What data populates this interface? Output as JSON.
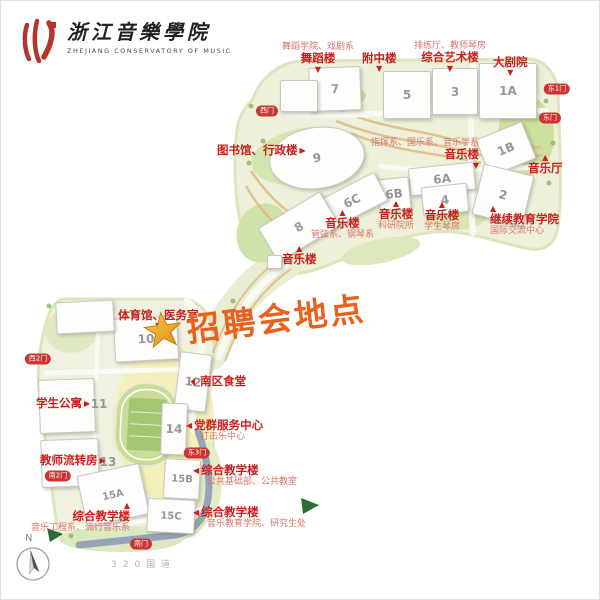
{
  "logo": {
    "title": "浙江音樂學院",
    "subtitle": "ZHEJIANG CONSERVATORY OF MUSIC"
  },
  "announcement": {
    "text": "招聘会地点",
    "color": "#e8611d",
    "star_color": "#f2a71f"
  },
  "compass": {
    "label": "N"
  },
  "highway": {
    "label": "320国道"
  },
  "colors": {
    "label_red": "#c8201d",
    "sub_red": "#d6756b",
    "gate_red": "#cc3433",
    "number_gray": "#97979a",
    "land_green": "#eef0da",
    "road_blue": "#97a3b8"
  },
  "map": {
    "buildings": [
      {
        "number": "7",
        "x": 308,
        "y": 66,
        "w": 50,
        "h": 42,
        "rot": -2
      },
      {
        "number": "5",
        "x": 382,
        "y": 70,
        "w": 46,
        "h": 46,
        "rot": 0
      },
      {
        "number": "3",
        "x": 431,
        "y": 67,
        "w": 44,
        "h": 45,
        "rot": 0
      },
      {
        "number": "1A",
        "x": 478,
        "y": 62,
        "w": 56,
        "h": 54,
        "rot": 0
      },
      {
        "number": "1B",
        "x": 480,
        "y": 128,
        "w": 48,
        "h": 38,
        "rot": -22
      },
      {
        "number": "2",
        "x": 476,
        "y": 168,
        "w": 50,
        "h": 50,
        "rot": 14
      },
      {
        "number": "9",
        "x": 268,
        "y": 126,
        "w": 94,
        "h": 60,
        "rot": -8,
        "shape": "ellipse"
      },
      {
        "number": "6A",
        "x": 408,
        "y": 164,
        "w": 64,
        "h": 26,
        "rot": -6
      },
      {
        "number": "6B",
        "x": 377,
        "y": 177,
        "w": 30,
        "h": 30,
        "rot": -6
      },
      {
        "number": "6C",
        "x": 318,
        "y": 184,
        "w": 64,
        "h": 30,
        "rot": -27
      },
      {
        "number": "4",
        "x": 421,
        "y": 184,
        "w": 44,
        "h": 27,
        "rot": -6
      },
      {
        "number": "8",
        "x": 262,
        "y": 206,
        "w": 70,
        "h": 38,
        "rot": -31
      },
      {
        "number": "",
        "x": 279,
        "y": 79,
        "w": 36,
        "h": 30,
        "rot": 0
      },
      {
        "number": "",
        "x": 266,
        "y": 254,
        "w": 13,
        "h": 12,
        "rot": 0
      },
      {
        "number": "10",
        "x": 113,
        "y": 316,
        "w": 62,
        "h": 42,
        "rot": -3
      },
      {
        "number": "",
        "x": 55,
        "y": 300,
        "w": 56,
        "h": 30,
        "rot": -3
      },
      {
        "number": "12",
        "x": 176,
        "y": 352,
        "w": 30,
        "h": 56,
        "rot": 7
      },
      {
        "number": "11",
        "x": 38,
        "y": 378,
        "w": 54,
        "h": 52,
        "rot": -2,
        "nx": 98,
        "ny": 403
      },
      {
        "number": "14",
        "x": 160,
        "y": 402,
        "w": 24,
        "h": 50,
        "rot": 2
      },
      {
        "number": "13",
        "x": 40,
        "y": 438,
        "w": 56,
        "h": 46,
        "rot": -2,
        "nx": 107,
        "ny": 461
      },
      {
        "number": "15B",
        "x": 163,
        "y": 458,
        "w": 34,
        "h": 38,
        "rot": 3
      },
      {
        "number": "15A",
        "x": 80,
        "y": 468,
        "w": 62,
        "h": 50,
        "rot": -12
      },
      {
        "number": "15C",
        "x": 146,
        "y": 498,
        "w": 46,
        "h": 32,
        "rot": 3
      }
    ],
    "labels": [
      {
        "main": "舞蹈楼",
        "sub": "舞蹈学院、戏剧系",
        "subpos": "above",
        "tri": "down",
        "tripos": "below",
        "x": 281,
        "y": 41,
        "align": "center"
      },
      {
        "main": "附中楼",
        "tri": "down",
        "tripos": "below",
        "x": 361,
        "y": 51,
        "align": "center"
      },
      {
        "main": "综合艺术楼",
        "sub": "排练厅、教师琴房",
        "subpos": "above",
        "tri": "down",
        "tripos": "below",
        "x": 413,
        "y": 40,
        "align": "center"
      },
      {
        "main": "大剧院",
        "tri": "down",
        "tripos": "below",
        "x": 492,
        "y": 55,
        "align": "center"
      },
      {
        "main": "图书馆、行政楼",
        "tri": "right",
        "tripos": "right",
        "x": 216,
        "y": 143,
        "align": "start"
      },
      {
        "main": "音乐楼",
        "sub": "指挥系、国乐系、音乐学系",
        "subpos": "above",
        "tri": "down",
        "tripos": "below",
        "x": 370,
        "y": 137,
        "align": "end"
      },
      {
        "main": "音乐厅",
        "tri": "up",
        "tripos": "above",
        "x": 527,
        "y": 153,
        "align": "center"
      },
      {
        "main": "继续教育学院",
        "sub": "国际交流中心",
        "subpos": "below",
        "tri": "up",
        "tripos": "above",
        "x": 489,
        "y": 204,
        "align": "start"
      },
      {
        "main": "音乐楼",
        "sub": "科研院所",
        "subpos": "below",
        "tri": "up",
        "tripos": "above",
        "x": 377,
        "y": 199,
        "align": "center"
      },
      {
        "main": "音乐楼",
        "sub": "管弦系、钢琴系",
        "subpos": "below",
        "tri": "up",
        "tripos": "above",
        "x": 310,
        "y": 208,
        "align": "center"
      },
      {
        "main": "音乐楼",
        "sub": "学生琴房",
        "subpos": "below",
        "tri": "up",
        "tripos": "above",
        "x": 423,
        "y": 200,
        "align": "center"
      },
      {
        "main": "音乐楼",
        "tri": "up",
        "tripos": "above",
        "x": 281,
        "y": 244,
        "align": "center"
      },
      {
        "main": "体育馆、医务室",
        "tri": "down",
        "tripos": "below",
        "x": 117,
        "y": 308,
        "align": "center"
      },
      {
        "main": "南区食堂",
        "tri": "upleft",
        "tripos": "left",
        "x": 191,
        "y": 374,
        "align": "start"
      },
      {
        "main": "学生公寓",
        "tri": "right",
        "tripos": "right",
        "x": 35,
        "y": 396,
        "align": "start"
      },
      {
        "main": "党群服务中心",
        "sub": "打击乐中心",
        "subpos": "below",
        "tri": "left",
        "tripos": "left",
        "x": 185,
        "y": 418,
        "align": "start",
        "subindent": 14
      },
      {
        "main": "教师流转房",
        "tri": "right",
        "tripos": "right",
        "x": 39,
        "y": 453,
        "align": "start"
      },
      {
        "main": "综合教学楼",
        "sub": "公共基础部、公共教室",
        "subpos": "below",
        "tri": "left",
        "tripos": "left",
        "x": 192,
        "y": 463,
        "align": "start",
        "subindent": 14
      },
      {
        "main": "综合教学楼",
        "sub": "音乐工程系、流行音乐系",
        "subpos": "below",
        "tri": "up",
        "tripos": "above",
        "x": 30,
        "y": 501,
        "align": "end"
      },
      {
        "main": "综合教学楼",
        "sub": "音乐教育学院、研究生处",
        "subpos": "below",
        "tri": "left",
        "tripos": "left",
        "x": 192,
        "y": 505,
        "align": "start",
        "subindent": 14
      }
    ],
    "gates": [
      {
        "label": "西门",
        "x": 266,
        "y": 110
      },
      {
        "label": "东1门",
        "x": 556,
        "y": 88
      },
      {
        "label": "东门",
        "x": 549,
        "y": 117
      },
      {
        "label": "西2门",
        "x": 37,
        "y": 358
      },
      {
        "label": "东3门",
        "x": 196,
        "y": 452
      },
      {
        "label": "南2门",
        "x": 57,
        "y": 475
      },
      {
        "label": "南门",
        "x": 140,
        "y": 543
      }
    ]
  }
}
